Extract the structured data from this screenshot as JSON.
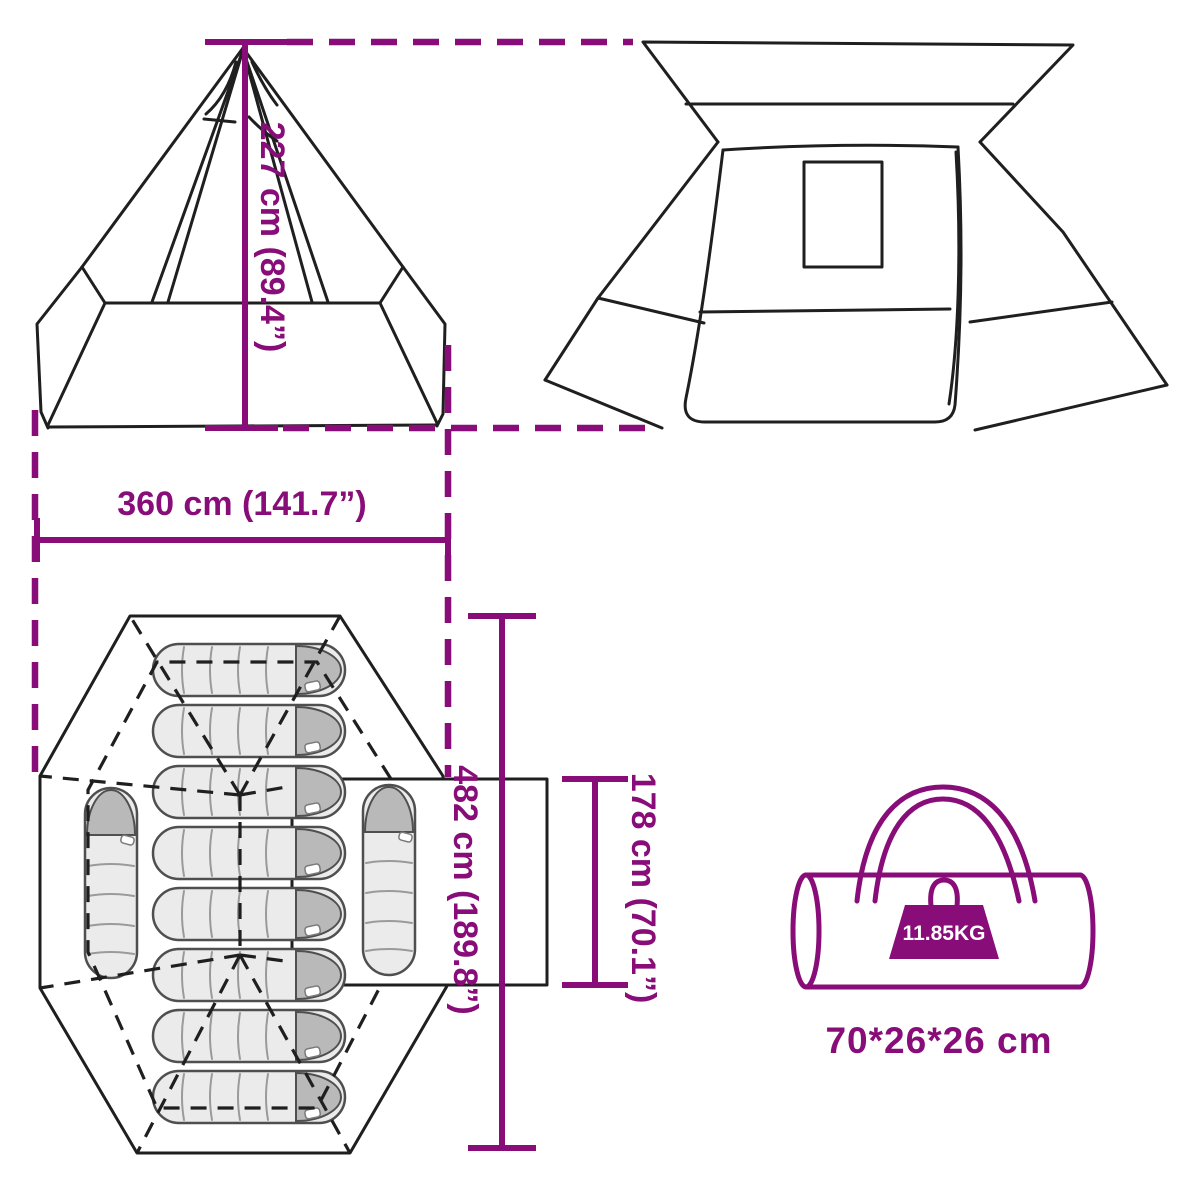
{
  "palette": {
    "accent": "#880d78",
    "line_color": "#1f1f1f",
    "sleeping_bag_fill": "#ebebeb",
    "sleeping_bag_cap": "#b9b9b9",
    "background": "#ffffff"
  },
  "measurements": {
    "height": "227 cm (89.4”)",
    "width": "360 cm (141.7”)",
    "depth": "482 cm (189.8”)",
    "porch": "178 cm (70.1”)"
  },
  "package": {
    "weight": "11.85KG",
    "size": "70*26*26 cm"
  },
  "views": {
    "front_elevation": {
      "icon": "teepee-front-view"
    },
    "rear_elevation": {
      "icon": "tent-rear-view-with-window"
    },
    "floor_plan": {
      "icon": "tent-floor-plan",
      "horizontal_sleeping_bags": 8,
      "vertical_sleeping_bags": 2,
      "total_sleeping_bags": 10
    },
    "carry_bag": {
      "icon": "duffel-carry-bag",
      "weight_icon": "kettlebell-weight-icon"
    }
  }
}
